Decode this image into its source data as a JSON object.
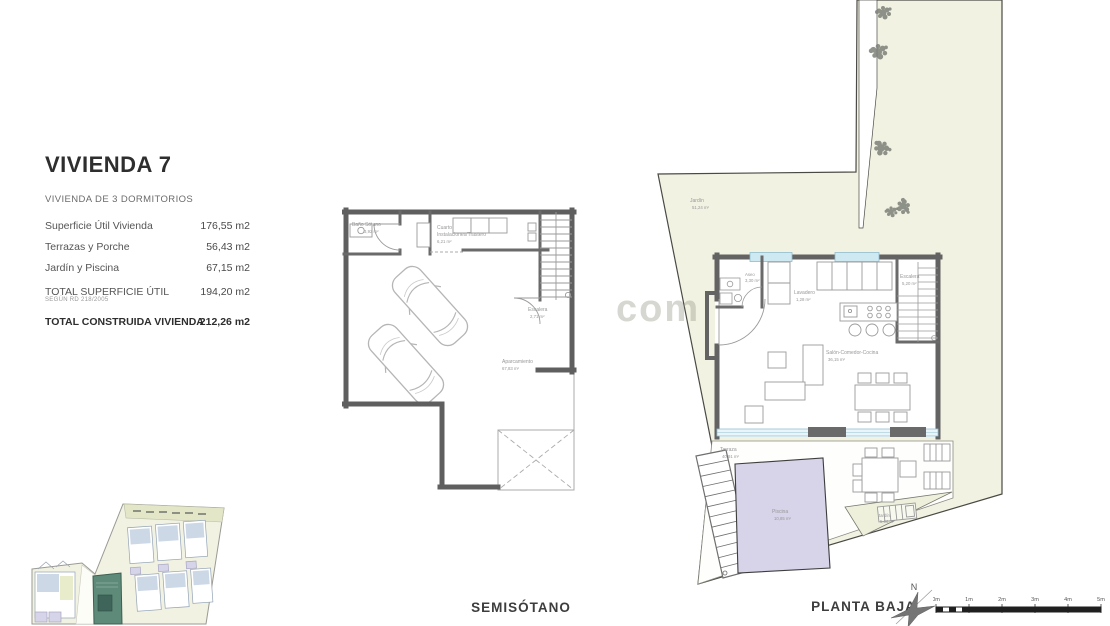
{
  "title_block": {
    "title": "VIVIENDA 7",
    "subtitle": "VIVIENDA DE 3 DORMITORIOS",
    "rows": [
      {
        "label": "Superficie Útil Vivienda",
        "value": "176,55 m2"
      },
      {
        "label": "Terrazas y Porche",
        "value": "56,43 m2"
      },
      {
        "label": "Jardín y Piscina",
        "value": "67,15 m2"
      },
      {
        "label": "TOTAL SUPERFICIE ÚTIL",
        "value": "194,20 m2",
        "note": "SEGÚN RD 218/2005"
      },
      {
        "label": "TOTAL CONSTRUIDA VIVIENDA",
        "value": "212,26 m2"
      }
    ]
  },
  "basement": {
    "floor_label": "SEMISÓTANO",
    "rooms": {
      "bano": {
        "name": "Baño Sótano",
        "area": "3,92 m²"
      },
      "cuarto": {
        "line1": "Cuarto",
        "line2": "Instalaciones/Trastero",
        "area": "6,21 m²"
      },
      "escalera": {
        "name": "Escalera",
        "area": "2,71 m²"
      },
      "aparcamiento": {
        "name": "Aparcamiento",
        "area": "67,83 m²"
      }
    }
  },
  "ground_floor": {
    "floor_label": "PLANTA BAJA",
    "rooms": {
      "jardin": {
        "name": "Jardín",
        "area": "51,24 m²"
      },
      "aseo": {
        "name": "Aseo",
        "area": "3,30 m²"
      },
      "lavadero": {
        "name": "Lavadero",
        "area": "1,28 m²"
      },
      "escalera": {
        "name": "Escalera",
        "area": "5,20 m²"
      },
      "salon": {
        "name": "Salón-Comedor-Cocina",
        "area": "36,15 m²"
      },
      "terraza": {
        "name": "Terraza",
        "area": "40,91 m²"
      },
      "piscina": {
        "name": "Piscina",
        "area": "10,85 m²"
      },
      "jardin_small": {
        "name": "Jardín",
        "area": "5,06 m²"
      }
    }
  },
  "compass": {
    "north_label": "N"
  },
  "scale_bar": {
    "ticks": [
      "0m",
      "1m",
      "2m",
      "3m",
      "4m",
      "5m"
    ]
  },
  "watermark": "com",
  "colors": {
    "wall": "#5f5f5f",
    "garden": "#f2f2e3",
    "pool": "#d7d3e8",
    "window_glass": "#cfe9f2",
    "site_highlight": "#5e8a79"
  }
}
